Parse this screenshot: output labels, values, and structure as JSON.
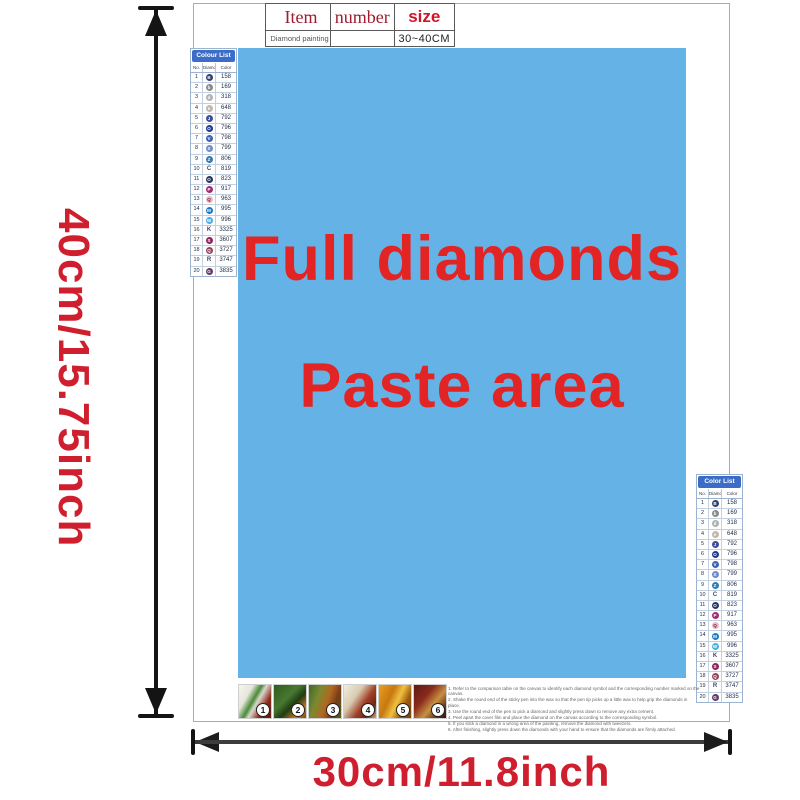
{
  "item_table": {
    "headers": {
      "item": "Item",
      "number": "number",
      "size": "size"
    },
    "row": {
      "item": "Diamond painting",
      "number": "",
      "size": "30~40CM"
    }
  },
  "paste_area": {
    "line1": "Full diamonds",
    "line2": "Paste area",
    "bg_color": "#65b2e6",
    "text_color": "#e32424"
  },
  "dimensions": {
    "height_label": "40cm/15.75inch",
    "width_label": "30cm/11.8inch",
    "label_color": "#cf1f2e"
  },
  "color_list": {
    "title_left": "Colour List",
    "title_right": "Color List",
    "columns": [
      "No.",
      "Diamond",
      "Color"
    ],
    "header_bg": "#3b6cc7",
    "rows": [
      {
        "no": "1",
        "sym": "B",
        "chip": "#31406f",
        "code": "158"
      },
      {
        "no": "2",
        "sym": "b",
        "chip": "#87898c",
        "code": "169"
      },
      {
        "no": "3",
        "sym": "d",
        "chip": "#aeb0b2",
        "code": "318"
      },
      {
        "no": "4",
        "sym": "e",
        "chip": "#bdbaab",
        "code": "648"
      },
      {
        "no": "5",
        "sym": "J",
        "chip": "#3c4d9d",
        "code": "792"
      },
      {
        "no": "6",
        "sym": "O",
        "chip": "#1d3a95",
        "code": "796"
      },
      {
        "no": "7",
        "sym": "V",
        "chip": "#3a62b4",
        "code": "798"
      },
      {
        "no": "8",
        "sym": "X",
        "chip": "#6d8bcd",
        "code": "799"
      },
      {
        "no": "9",
        "sym": "Z",
        "chip": "#2e7cb0",
        "code": "806"
      },
      {
        "no": "10",
        "sym": "C",
        "chip": "",
        "code": "819"
      },
      {
        "no": "11",
        "sym": "O",
        "chip": "#263562",
        "code": "823"
      },
      {
        "no": "12",
        "sym": "P",
        "chip": "#a02b71",
        "code": "917"
      },
      {
        "no": "13",
        "sym": "Q",
        "chip": "#efb9c2",
        "dark": true,
        "code": "963"
      },
      {
        "no": "14",
        "sym": "M",
        "chip": "#1d79c4",
        "code": "995"
      },
      {
        "no": "15",
        "sym": "W",
        "chip": "#46aee2",
        "code": "996"
      },
      {
        "no": "16",
        "sym": "K",
        "chip": "",
        "code": "3325"
      },
      {
        "no": "17",
        "sym": "S",
        "chip": "#8e2160",
        "code": "3607"
      },
      {
        "no": "18",
        "sym": "Q",
        "chip": "#96435f",
        "code": "3727"
      },
      {
        "no": "19",
        "sym": "R",
        "chip": "",
        "code": "3747"
      },
      {
        "no": "20",
        "sym": "G",
        "chip": "#613a67",
        "code": "3835"
      }
    ]
  },
  "steps": {
    "tiles": [
      {
        "n": "1",
        "bg": "linear-gradient(120deg,#f6f5ef 0%,#e6e6da 28%,#4a8a38 45%,#d8d8cc 55%,#8f2a1e 75%,#5e1a10 100%)"
      },
      {
        "n": "2",
        "bg": "linear-gradient(135deg,#2e5c1e 0%,#487830 40%,#1e3c14 60%,#c87820 82%,#8a4a14 100%)"
      },
      {
        "n": "3",
        "bg": "linear-gradient(110deg,#3e6a28 0%,#7a8a30 30%,#b06820 55%,#7a3c16 75%,#4e5c22 100%)"
      },
      {
        "n": "4",
        "bg": "linear-gradient(125deg,#f0ece0 0%,#d8ccb0 35%,#a04028 60%,#6e2418 80%,#caa878 100%)"
      },
      {
        "n": "5",
        "bg": "linear-gradient(115deg,#e8a020 0%,#c87810 35%,#f0c040 55%,#a05c0c 75%,#784408 100%)"
      },
      {
        "n": "6",
        "bg": "linear-gradient(130deg,#5e1a14 0%,#8a2a1c 35%,#c89040 60%,#6e3c1e 80%,#3e1008 100%)"
      }
    ]
  },
  "instructions": [
    "1. Refer to the comparison table on the canvas to identify each diamond symbol and the corresponding number marked on the canvas.",
    "2. Shake the round end of the sticky pen into the wax so that the pen tip picks up a little wax to help grip the diamonds in place.",
    "3. Use the round end of the pen to pick a diamond and slightly press down to remove any extra cement.",
    "4. Peel apart the cover film and place the diamond on the canvas according to the corresponding symbol.",
    "5. If you stick a diamond in a wrong area of the painting, remove the diamond with tweezers.",
    "6. After finishing, slightly press down the diamonds with your hand to ensure that the diamonds are firmly attached."
  ]
}
